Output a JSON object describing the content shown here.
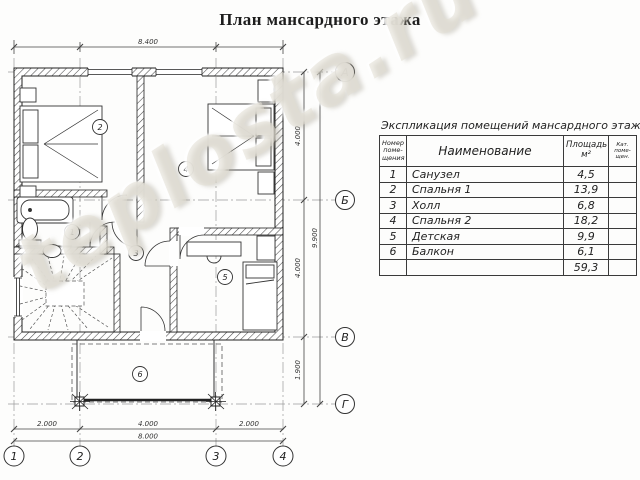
{
  "title": "План мансардного этажа",
  "watermark": "teplosta.ru",
  "plan": {
    "dim_top_total": "8.400",
    "dim_right": [
      "4.000",
      "4.000",
      "1.900"
    ],
    "dim_right_total": "9.900",
    "dim_bottom": [
      "2.000",
      "4.000",
      "2.000"
    ],
    "dim_bottom_total": "8.000",
    "axes_rows": [
      "А",
      "Б",
      "В",
      "Г"
    ],
    "axes_cols": [
      "1",
      "2",
      "3",
      "4"
    ],
    "rooms": [
      "1",
      "2",
      "3",
      "4",
      "5",
      "6"
    ]
  },
  "table": {
    "caption": "Экспликация помещений мансардного этажа",
    "header": {
      "num_lines": [
        "Номер",
        "поме-",
        "щения"
      ],
      "name": "Наименование",
      "area_lines": [
        "Площадь",
        "м²"
      ],
      "cat_lines": [
        "Кат.",
        "поме-",
        "щен."
      ]
    },
    "rows": [
      {
        "num": "1",
        "name": "Санузел",
        "area": "4,5"
      },
      {
        "num": "2",
        "name": "Спальня 1",
        "area": "13,9"
      },
      {
        "num": "3",
        "name": "Холл",
        "area": "6,8"
      },
      {
        "num": "4",
        "name": "Спальня 2",
        "area": "18,2"
      },
      {
        "num": "5",
        "name": "Детская",
        "area": "9,9"
      },
      {
        "num": "6",
        "name": "Балкон",
        "area": "6,1"
      }
    ],
    "total_area": "59,3"
  }
}
